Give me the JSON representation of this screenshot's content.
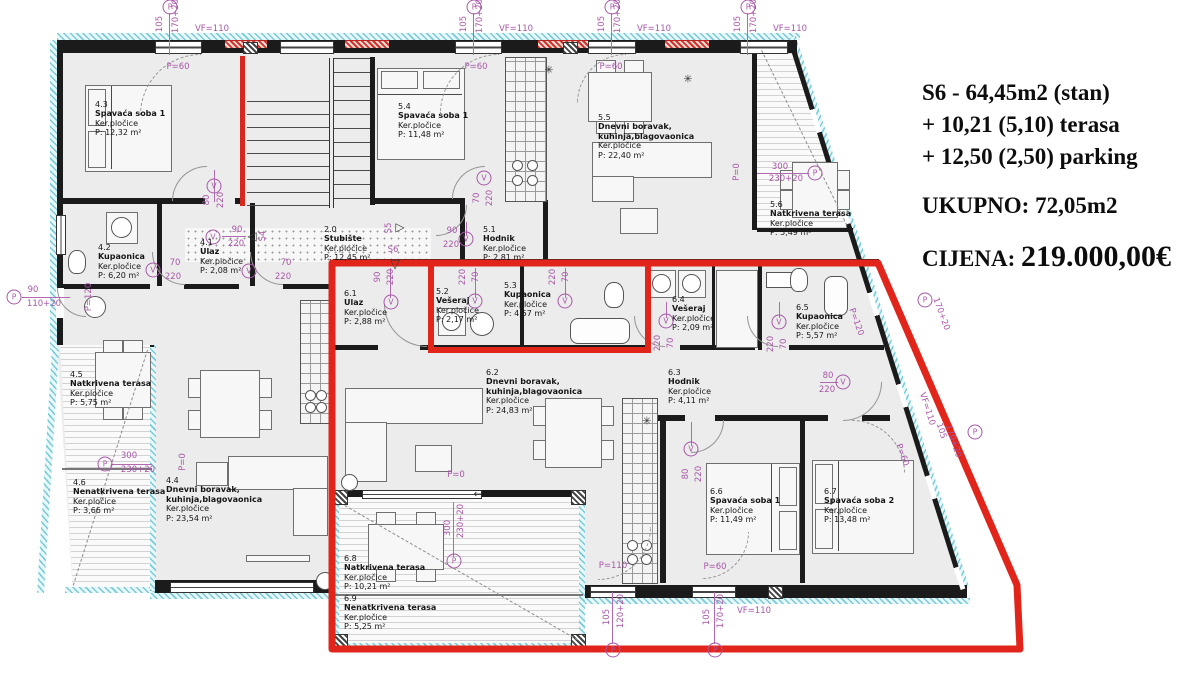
{
  "info_panel": {
    "line1": "S6 - 64,45m2 (stan)",
    "line2": "+ 10,21 (5,10) terasa",
    "line3": "+ 12,50 (2,50) parking",
    "total": "UKUPNO: 72,05m2",
    "price_label": "CIJENA:",
    "price_value": "219.000,00€"
  },
  "colors": {
    "highlight_red": "#e1251b",
    "dimension_purple": "#a757a7",
    "hatch_teal": "#79ccd7",
    "wall_black": "#1b1b1b",
    "floor_gray": "#ececec"
  },
  "rooms": [
    {
      "id": "4.3",
      "name": "Spavaća soba 1",
      "finish": "Ker.pločice",
      "area": "P: 12,32 m²",
      "x": 95,
      "y": 100
    },
    {
      "id": "4.2",
      "name": "Kupaonica",
      "finish": "Ker.pločice",
      "area": "P: 6,20 m²",
      "x": 98,
      "y": 243
    },
    {
      "id": "4.1",
      "name": "Ulaz",
      "finish": "Ker.pločice",
      "area": "P: 2,08 m²",
      "x": 200,
      "y": 238
    },
    {
      "id": "2.0",
      "name": "Stubište",
      "finish": "Ker.pločice",
      "area": "P: 12,45 m²",
      "x": 324,
      "y": 225
    },
    {
      "id": "5.4",
      "name": "Spavaća soba 1",
      "finish": "Ker.pločice",
      "area": "P: 11,48 m²",
      "x": 398,
      "y": 102
    },
    {
      "id": "5.1",
      "name": "Hodnik",
      "finish": "Ker.pločice",
      "area": "P: 2,81 m²",
      "x": 483,
      "y": 225
    },
    {
      "id": "5.5",
      "name": "Dnevni boravak,\nkuhinja,blagovaonica",
      "finish": "Ker.pločice",
      "area": "P: 22,40 m²",
      "x": 598,
      "y": 113
    },
    {
      "id": "5.6",
      "name": "Natkrivena terasa",
      "finish": "Ker.pločice",
      "area": "P: 5,49 m²",
      "x": 770,
      "y": 200
    },
    {
      "id": "5.2",
      "name": "Vešeraj",
      "finish": "Ker.pločice",
      "area": "P: 2,17 m²",
      "x": 436,
      "y": 287
    },
    {
      "id": "5.3",
      "name": "Kupaonica",
      "finish": "Ker.pločice",
      "area": "P: 4,57 m²",
      "x": 504,
      "y": 281
    },
    {
      "id": "6.1",
      "name": "Ulaz",
      "finish": "Ker.pločice",
      "area": "P: 2,88 m²",
      "x": 344,
      "y": 289
    },
    {
      "id": "6.4",
      "name": "Vešeraj",
      "finish": "Ker.pločice",
      "area": "P: 2,09 m²",
      "x": 672,
      "y": 295
    },
    {
      "id": "6.5",
      "name": "Kupaonica",
      "finish": "Ker.pločice",
      "area": "P: 5,57 m²",
      "x": 796,
      "y": 303
    },
    {
      "id": "6.3",
      "name": "Hodnik",
      "finish": "Ker.pločice",
      "area": "P: 4,11 m²",
      "x": 668,
      "y": 368
    },
    {
      "id": "6.2",
      "name": "Dnevni boravak,\nkuhinja,blagovaonica",
      "finish": "Ker.pločice",
      "area": "P: 24,83 m²",
      "x": 486,
      "y": 368
    },
    {
      "id": "4.4",
      "name": "Dnevni boravak,\nkuhinja,blagovaonica",
      "finish": "Ker.pločice",
      "area": "P: 23,54 m²",
      "x": 166,
      "y": 476
    },
    {
      "id": "4.5",
      "name": "Natkrivena terasa",
      "finish": "Ker.pločice",
      "area": "P: 5,75 m²",
      "x": 70,
      "y": 370
    },
    {
      "id": "4.6",
      "name": "Nenatkrivena terasa",
      "finish": "Ker.pločice",
      "area": "P: 3,66 m²",
      "x": 73,
      "y": 478
    },
    {
      "id": "6.6",
      "name": "Spavaća soba 1",
      "finish": "Ker.pločice",
      "area": "P: 11,49 m²",
      "x": 710,
      "y": 487
    },
    {
      "id": "6.7",
      "name": "Spavaća soba 2",
      "finish": "Ker.pločice",
      "area": "P: 13,48 m²",
      "x": 824,
      "y": 487
    },
    {
      "id": "6.8",
      "name": "Natkrivena terasa",
      "finish": "Ker.pločice",
      "area": "P: 10,21 m²",
      "x": 344,
      "y": 554
    },
    {
      "id": "6.9",
      "name": "Nenatkrivena terasa",
      "finish": "Ker.pločice",
      "area": "P: 5,25 m²",
      "x": 344,
      "y": 594
    }
  ],
  "annotations": [
    {
      "c": "P",
      "x": 170,
      "y": 7
    },
    {
      "t": "105",
      "x": 160,
      "y": 24,
      "r": -90
    },
    {
      "t": "170+20",
      "x": 176,
      "y": 16,
      "r": -90
    },
    {
      "t": "VF=110",
      "x": 212,
      "y": 29
    },
    {
      "c": "P",
      "x": 474,
      "y": 7
    },
    {
      "t": "105",
      "x": 464,
      "y": 24,
      "r": -90
    },
    {
      "t": "170+20",
      "x": 480,
      "y": 16,
      "r": -90
    },
    {
      "t": "VF=110",
      "x": 516,
      "y": 29
    },
    {
      "c": "P",
      "x": 612,
      "y": 7
    },
    {
      "t": "105",
      "x": 602,
      "y": 24,
      "r": -90
    },
    {
      "t": "170+20",
      "x": 618,
      "y": 16,
      "r": -90
    },
    {
      "t": "VF=110",
      "x": 654,
      "y": 29
    },
    {
      "c": "P",
      "x": 748,
      "y": 7
    },
    {
      "t": "105",
      "x": 738,
      "y": 24,
      "r": -90
    },
    {
      "t": "170+20",
      "x": 754,
      "y": 16,
      "r": -90
    },
    {
      "t": "VF=110",
      "x": 790,
      "y": 29
    },
    {
      "t": "P=60",
      "x": 178,
      "y": 67
    },
    {
      "t": "P=60",
      "x": 476,
      "y": 67
    },
    {
      "t": "P=60",
      "x": 611,
      "y": 67
    },
    {
      "c": "P",
      "x": 14,
      "y": 297
    },
    {
      "t": "90",
      "x": 33,
      "y": 290
    },
    {
      "t": "110+20",
      "x": 44,
      "y": 304
    },
    {
      "t": "P=120",
      "x": 89,
      "y": 297,
      "r": -90
    },
    {
      "c": "P",
      "x": 105,
      "y": 464
    },
    {
      "t": "300",
      "x": 129,
      "y": 456
    },
    {
      "t": "230+20",
      "x": 138,
      "y": 470
    },
    {
      "t": "300",
      "x": 780,
      "y": 167
    },
    {
      "t": "230+20",
      "x": 786,
      "y": 179
    },
    {
      "c": "P",
      "x": 815,
      "y": 173
    },
    {
      "t": "P=0",
      "x": 737,
      "y": 172,
      "r": -90
    },
    {
      "c": "V",
      "x": 214,
      "y": 186
    },
    {
      "t": "80",
      "x": 207,
      "y": 200,
      "r": -90
    },
    {
      "t": "220",
      "x": 221,
      "y": 200,
      "r": -90
    },
    {
      "c": "V",
      "x": 153,
      "y": 270
    },
    {
      "t": "70",
      "x": 175,
      "y": 263
    },
    {
      "t": "220",
      "x": 173,
      "y": 277
    },
    {
      "c": "V",
      "x": 249,
      "y": 271
    },
    {
      "t": "70",
      "x": 286,
      "y": 263
    },
    {
      "t": "220",
      "x": 283,
      "y": 277
    },
    {
      "c": "V",
      "x": 213,
      "y": 237
    },
    {
      "t": "90",
      "x": 237,
      "y": 230
    },
    {
      "t": "220",
      "x": 236,
      "y": 244
    },
    {
      "g": "◁",
      "x": 252,
      "y": 236
    },
    {
      "t": "S4",
      "x": 263,
      "y": 236,
      "r": -90
    },
    {
      "t": "S5",
      "x": 389,
      "y": 228,
      "r": -90
    },
    {
      "g": "▷",
      "x": 400,
      "y": 227
    },
    {
      "t": "S6",
      "x": 393,
      "y": 250
    },
    {
      "g": "▽",
      "x": 395,
      "y": 264
    },
    {
      "c": "V",
      "x": 484,
      "y": 178
    },
    {
      "t": "70",
      "x": 477,
      "y": 198,
      "r": -90
    },
    {
      "t": "220",
      "x": 490,
      "y": 198,
      "r": -90
    },
    {
      "c": "V",
      "x": 466,
      "y": 239
    },
    {
      "t": "90",
      "x": 452,
      "y": 231
    },
    {
      "t": "220",
      "x": 451,
      "y": 245
    },
    {
      "c": "V",
      "x": 475,
      "y": 301
    },
    {
      "t": "220",
      "x": 463,
      "y": 277,
      "r": -90
    },
    {
      "t": "70",
      "x": 476,
      "y": 277,
      "r": -90
    },
    {
      "c": "V",
      "x": 565,
      "y": 301
    },
    {
      "t": "220",
      "x": 553,
      "y": 277,
      "r": -90
    },
    {
      "t": "70",
      "x": 566,
      "y": 277,
      "r": -90
    },
    {
      "c": "V",
      "x": 391,
      "y": 302
    },
    {
      "t": "90",
      "x": 378,
      "y": 277,
      "r": -90
    },
    {
      "t": "220",
      "x": 391,
      "y": 277,
      "r": -90
    },
    {
      "c": "V",
      "x": 666,
      "y": 321
    },
    {
      "t": "220",
      "x": 658,
      "y": 343,
      "r": -90
    },
    {
      "t": "70",
      "x": 671,
      "y": 343,
      "r": -90
    },
    {
      "c": "V",
      "x": 779,
      "y": 322
    },
    {
      "t": "220",
      "x": 771,
      "y": 344,
      "r": -90
    },
    {
      "t": "70",
      "x": 784,
      "y": 344,
      "r": -90
    },
    {
      "t": "80",
      "x": 828,
      "y": 376
    },
    {
      "t": "220",
      "x": 827,
      "y": 390
    },
    {
      "c": "V",
      "x": 843,
      "y": 382
    },
    {
      "c": "V",
      "x": 691,
      "y": 449
    },
    {
      "t": "80",
      "x": 686,
      "y": 474,
      "r": -90
    },
    {
      "t": "220",
      "x": 699,
      "y": 474,
      "r": -90
    },
    {
      "c": "P",
      "x": 925,
      "y": 300
    },
    {
      "t": "170+20",
      "x": 941,
      "y": 314,
      "r": 70
    },
    {
      "t": "P=120",
      "x": 856,
      "y": 322,
      "r": 70
    },
    {
      "t": "VF=110",
      "x": 927,
      "y": 409,
      "r": 72
    },
    {
      "t": "105",
      "x": 941,
      "y": 431,
      "r": 72
    },
    {
      "t": "170+20",
      "x": 953,
      "y": 441,
      "r": 72
    },
    {
      "c": "P",
      "x": 975,
      "y": 432
    },
    {
      "t": "P=60",
      "x": 902,
      "y": 455,
      "r": 70
    },
    {
      "t": "P=110",
      "x": 613,
      "y": 566
    },
    {
      "t": "P=60",
      "x": 715,
      "y": 567
    },
    {
      "t": "105",
      "x": 607,
      "y": 617,
      "r": -90
    },
    {
      "t": "120+20",
      "x": 621,
      "y": 611,
      "r": -90
    },
    {
      "c": "P",
      "x": 613,
      "y": 650
    },
    {
      "t": "105",
      "x": 707,
      "y": 617,
      "r": -90
    },
    {
      "t": "170+20",
      "x": 721,
      "y": 611,
      "r": -90
    },
    {
      "c": "P",
      "x": 715,
      "y": 650
    },
    {
      "t": "VF=110",
      "x": 754,
      "y": 611
    },
    {
      "t": "P=0",
      "x": 456,
      "y": 475
    },
    {
      "t": "300",
      "x": 448,
      "y": 528,
      "r": -90
    },
    {
      "t": "230+20",
      "x": 461,
      "y": 521,
      "r": -90
    },
    {
      "c": "P",
      "x": 454,
      "y": 561
    },
    {
      "t": "P=0",
      "x": 183,
      "y": 462,
      "r": -90
    },
    {
      "t": "✳",
      "x": 549,
      "y": 70,
      "s": 1
    },
    {
      "t": "✳",
      "x": 688,
      "y": 79,
      "s": 1
    },
    {
      "t": "✳",
      "x": 647,
      "y": 421,
      "s": 1
    },
    {
      "t": "←",
      "x": 478,
      "y": 494,
      "s": 1
    }
  ]
}
